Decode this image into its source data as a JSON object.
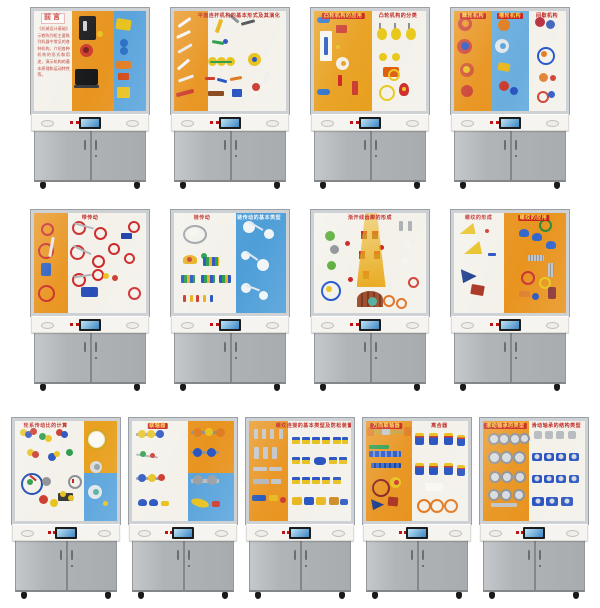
{
  "colors": {
    "frame": "#cfd2d4",
    "frame_edge": "#9aa0a4",
    "console": "#f5f4f1",
    "base_gray": "#b0b4b7",
    "banner_red": "#c8201a",
    "banner_yellow": "#ffd84d",
    "orange_panel": "#e8941f",
    "blue_panel": "#5aa4dc",
    "white_panel": "#f3f1ea",
    "indicator_red": "#c01212",
    "screen_black": "#1c1c1c",
    "wheel_black": "#1a1a1a"
  },
  "cabinets": [
    {
      "id": "r1c1",
      "row": 1,
      "motif": "machines",
      "banners": [
        {
          "text": "前言",
          "style": "red-title",
          "x": 17
        }
      ],
      "intro_text": "《机械设计基础》示教陈列柜主要陈列机器中常见的各种机构，介绍各种机构的形式和用途，演示机构的基本原理和运动特性等。",
      "bands": [
        {
          "w": 34,
          "colors": [
            "#f3f1ea"
          ]
        },
        {
          "w": 37,
          "colors": [
            "#e8941f"
          ]
        },
        {
          "w": 29,
          "colors": [
            "#5aa4dc"
          ]
        }
      ]
    },
    {
      "id": "r1c2",
      "row": 1,
      "motif": "linkages",
      "banners": [
        {
          "text": "平面连杆机构的基本形式及其演化",
          "style": "red-text",
          "x": 58
        }
      ],
      "bands": [
        {
          "w": 30,
          "colors": [
            "#e8941f"
          ]
        },
        {
          "w": 70,
          "colors": [
            "#f3f1ea"
          ]
        }
      ]
    },
    {
      "id": "r1c3",
      "row": 1,
      "motif": "cams",
      "banners": [
        {
          "text": "凸轮机构的应用",
          "style": "red-chip",
          "x": 26
        },
        {
          "text": "凸轮机构的分类",
          "style": "red-text",
          "x": 75
        }
      ],
      "bands": [
        {
          "w": 52,
          "colors": [
            "#e8a01f"
          ]
        },
        {
          "w": 48,
          "colors": [
            "#f3f1ea"
          ]
        }
      ]
    },
    {
      "id": "r1c4",
      "row": 1,
      "motif": "intermittent",
      "banners": [
        {
          "text": "棘轮机构",
          "style": "red-chip",
          "x": 17
        },
        {
          "text": "槽轮机构",
          "style": "red-chip",
          "x": 50
        },
        {
          "text": "间歇机构",
          "style": "red-text",
          "x": 83
        }
      ],
      "bands": [
        {
          "w": 34,
          "colors": [
            "#e8941f"
          ]
        },
        {
          "w": 33,
          "colors": [
            "#6aaede"
          ]
        },
        {
          "w": 33,
          "colors": [
            "#f3f1ea"
          ]
        }
      ]
    },
    {
      "id": "r2c1",
      "row": 2,
      "motif": "belts",
      "banners": [
        {
          "text": "带传动",
          "style": "red-text",
          "x": 50
        }
      ],
      "bands": [
        {
          "w": 30,
          "colors": [
            "#e8941f"
          ]
        },
        {
          "w": 70,
          "colors": [
            "#f3f1ea"
          ]
        }
      ]
    },
    {
      "id": "r2c2",
      "row": 2,
      "motif": "chains",
      "banners": [
        {
          "text": "链传动",
          "style": "red-text",
          "x": 25
        },
        {
          "text": "链传动的基本类型",
          "style": "white-text",
          "x": 76
        }
      ],
      "bands": [
        {
          "w": 55,
          "colors": [
            "#f3f1ea"
          ]
        },
        {
          "w": 45,
          "colors": [
            "#4e9ed8"
          ]
        }
      ]
    },
    {
      "id": "r2c3",
      "row": 2,
      "motif": "gearwedge",
      "banners": [
        {
          "text": "渐开线齿廓的形成",
          "style": "red-text",
          "x": 50
        }
      ],
      "bands": [
        {
          "w": 100,
          "colors": [
            "#f3f1ea"
          ]
        }
      ]
    },
    {
      "id": "r2c4",
      "row": 2,
      "motif": "screws",
      "banners": [
        {
          "text": "螺纹的形成",
          "style": "red-text",
          "x": 22
        },
        {
          "text": "螺纹的应用",
          "style": "red-chip",
          "x": 71
        }
      ],
      "bands": [
        {
          "w": 45,
          "colors": [
            "#f3f1ea"
          ]
        },
        {
          "w": 55,
          "colors": [
            "#e8941f"
          ]
        }
      ]
    },
    {
      "id": "r3c1",
      "row": 3,
      "motif": "geartrain",
      "banners": [
        {
          "text": "轮系传动比的计算",
          "style": "red-text",
          "x": 30
        }
      ],
      "bands": [
        {
          "w": 68,
          "colors": [
            "#f3f1ea"
          ]
        },
        {
          "w": 32,
          "colors": [
            "#e8a01f",
            "#5aa4dc"
          ]
        }
      ]
    },
    {
      "id": "r3c2",
      "row": 3,
      "motif": "couplings",
      "banners": [
        {
          "text": "联轴器",
          "style": "red-chip",
          "x": 25
        }
      ],
      "bands": [
        {
          "w": 55,
          "colors": [
            "#f3f1ea"
          ]
        },
        {
          "w": 45,
          "colors": [
            "#e8941f",
            "#5aa4dc"
          ]
        }
      ]
    },
    {
      "id": "r3c3",
      "row": 3,
      "motif": "boltpanel",
      "banners": [
        {
          "text": "螺纹连接的基本类型及防松装置",
          "style": "red-text",
          "x": 64
        }
      ],
      "bands": [
        {
          "w": 38,
          "colors": [
            "#e8941f"
          ]
        },
        {
          "w": 62,
          "colors": [
            "#f3f1ea"
          ]
        }
      ]
    },
    {
      "id": "r3c4",
      "row": 3,
      "motif": "clutch",
      "banners": [
        {
          "text": "万向联轴器",
          "style": "red-chip",
          "x": 20
        },
        {
          "text": "离合器",
          "style": "red-text",
          "x": 72
        }
      ],
      "bands": [
        {
          "w": 45,
          "colors": [
            "#e8941f"
          ]
        },
        {
          "w": 55,
          "colors": [
            "#f3f1ea"
          ]
        }
      ]
    },
    {
      "id": "r3c5",
      "row": 3,
      "motif": "bearings",
      "banners": [
        {
          "text": "滚动轴承的类型",
          "style": "red-chip",
          "x": 22
        },
        {
          "text": "滑动轴承的结构类型",
          "style": "red-text",
          "x": 72
        }
      ],
      "bands": [
        {
          "w": 45,
          "colors": [
            "#e8941f"
          ]
        },
        {
          "w": 55,
          "colors": [
            "#f3f1ea"
          ]
        }
      ]
    }
  ]
}
